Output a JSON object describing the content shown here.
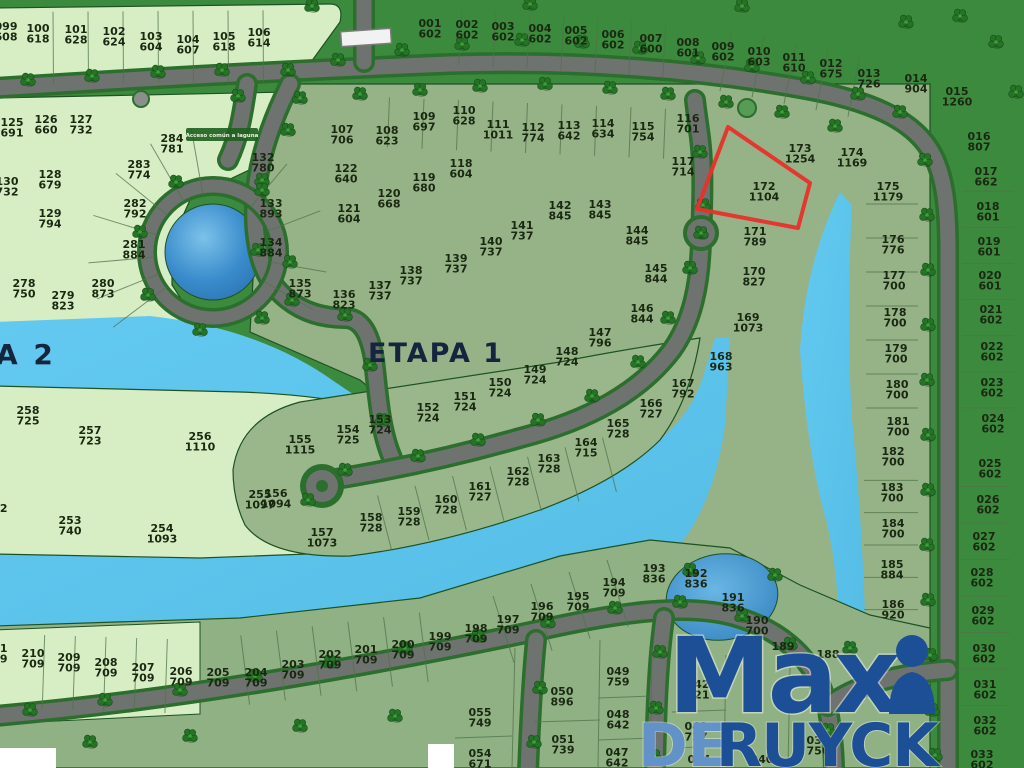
{
  "map": {
    "etapa1_label": "ETAPA 1",
    "etapa2_label": "A 2",
    "acceso_label": "Acceso común a laguna",
    "colors": {
      "water": "#5cc3ea",
      "lagoon": "#3a8ccc",
      "grass": "#3c8a3e",
      "sage_lot": "#96b287",
      "pale_lot": "#d7eec5",
      "road": "#6f736f",
      "hedge": "#2c6e2e",
      "label_text": "#1a2812",
      "etapa_text": "#14253d",
      "highlight_red": "#e8302a",
      "logo_blue": "#1d4f97",
      "logo_light_blue": "#6292c8"
    },
    "highlight": {
      "lot": "172",
      "area": "1104",
      "polygon": [
        [
          728,
          127
        ],
        [
          810,
          183
        ],
        [
          798,
          228
        ],
        [
          697,
          209
        ]
      ]
    },
    "logo": {
      "word1": "Max",
      "word1_suffix_icon": "person-icon",
      "word2a": "DE",
      "word2b": "RUYCK"
    },
    "lots": [
      {
        "n": "099",
        "a": "608",
        "x": 6,
        "y": 30
      },
      {
        "n": "100",
        "a": "618",
        "x": 38,
        "y": 32
      },
      {
        "n": "101",
        "a": "628",
        "x": 76,
        "y": 33
      },
      {
        "n": "102",
        "a": "624",
        "x": 114,
        "y": 35
      },
      {
        "n": "103",
        "a": "604",
        "x": 151,
        "y": 40
      },
      {
        "n": "104",
        "a": "607",
        "x": 188,
        "y": 43
      },
      {
        "n": "105",
        "a": "618",
        "x": 224,
        "y": 40
      },
      {
        "n": "106",
        "a": "614",
        "x": 259,
        "y": 36
      },
      {
        "n": "001",
        "a": "602",
        "x": 430,
        "y": 27
      },
      {
        "n": "002",
        "a": "602",
        "x": 467,
        "y": 28
      },
      {
        "n": "003",
        "a": "602",
        "x": 503,
        "y": 30
      },
      {
        "n": "004",
        "a": "602",
        "x": 540,
        "y": 32
      },
      {
        "n": "005",
        "a": "602",
        "x": 576,
        "y": 34
      },
      {
        "n": "006",
        "a": "602",
        "x": 613,
        "y": 38
      },
      {
        "n": "007",
        "a": "600",
        "x": 651,
        "y": 42
      },
      {
        "n": "008",
        "a": "601",
        "x": 688,
        "y": 46
      },
      {
        "n": "009",
        "a": "602",
        "x": 723,
        "y": 50
      },
      {
        "n": "010",
        "a": "603",
        "x": 759,
        "y": 55
      },
      {
        "n": "011",
        "a": "610",
        "x": 794,
        "y": 61
      },
      {
        "n": "012",
        "a": "675",
        "x": 831,
        "y": 67
      },
      {
        "n": "013",
        "a": "726",
        "x": 869,
        "y": 77
      },
      {
        "n": "014",
        "a": "904",
        "x": 916,
        "y": 82
      },
      {
        "n": "015",
        "a": "1260",
        "x": 957,
        "y": 95
      },
      {
        "n": "016",
        "a": "807",
        "x": 979,
        "y": 140
      },
      {
        "n": "017",
        "a": "662",
        "x": 986,
        "y": 175
      },
      {
        "n": "018",
        "a": "601",
        "x": 988,
        "y": 210
      },
      {
        "n": "019",
        "a": "601",
        "x": 989,
        "y": 245
      },
      {
        "n": "020",
        "a": "601",
        "x": 990,
        "y": 279
      },
      {
        "n": "021",
        "a": "602",
        "x": 991,
        "y": 313
      },
      {
        "n": "022",
        "a": "602",
        "x": 992,
        "y": 350
      },
      {
        "n": "023",
        "a": "602",
        "x": 992,
        "y": 386
      },
      {
        "n": "024",
        "a": "602",
        "x": 993,
        "y": 422
      },
      {
        "n": "025",
        "a": "602",
        "x": 990,
        "y": 467
      },
      {
        "n": "026",
        "a": "602",
        "x": 988,
        "y": 503
      },
      {
        "n": "027",
        "a": "602",
        "x": 984,
        "y": 540
      },
      {
        "n": "028",
        "a": "602",
        "x": 982,
        "y": 576
      },
      {
        "n": "029",
        "a": "602",
        "x": 983,
        "y": 614
      },
      {
        "n": "030",
        "a": "602",
        "x": 984,
        "y": 652
      },
      {
        "n": "031",
        "a": "602",
        "x": 985,
        "y": 688
      },
      {
        "n": "032",
        "a": "602",
        "x": 985,
        "y": 724
      },
      {
        "n": "033",
        "a": "602",
        "x": 982,
        "y": 758
      },
      {
        "n": "173",
        "a": "1254",
        "x": 800,
        "y": 152
      },
      {
        "n": "174",
        "a": "1169",
        "x": 852,
        "y": 156
      },
      {
        "n": "175",
        "a": "1179",
        "x": 888,
        "y": 190
      },
      {
        "n": "176",
        "a": "776",
        "x": 893,
        "y": 243
      },
      {
        "n": "177",
        "a": "700",
        "x": 894,
        "y": 279
      },
      {
        "n": "178",
        "a": "700",
        "x": 895,
        "y": 316
      },
      {
        "n": "179",
        "a": "700",
        "x": 896,
        "y": 352
      },
      {
        "n": "180",
        "a": "700",
        "x": 897,
        "y": 388
      },
      {
        "n": "181",
        "a": "700",
        "x": 898,
        "y": 425
      },
      {
        "n": "182",
        "a": "700",
        "x": 893,
        "y": 455
      },
      {
        "n": "183",
        "a": "700",
        "x": 892,
        "y": 491
      },
      {
        "n": "184",
        "a": "700",
        "x": 893,
        "y": 527
      },
      {
        "n": "185",
        "a": "884",
        "x": 892,
        "y": 568
      },
      {
        "n": "186",
        "a": "920",
        "x": 893,
        "y": 608
      },
      {
        "n": "107",
        "a": "706",
        "x": 342,
        "y": 133
      },
      {
        "n": "108",
        "a": "623",
        "x": 387,
        "y": 134
      },
      {
        "n": "109",
        "a": "697",
        "x": 424,
        "y": 120
      },
      {
        "n": "110",
        "a": "628",
        "x": 464,
        "y": 114
      },
      {
        "n": "111",
        "a": "1011",
        "x": 498,
        "y": 128
      },
      {
        "n": "112",
        "a": "774",
        "x": 533,
        "y": 131
      },
      {
        "n": "113",
        "a": "642",
        "x": 569,
        "y": 129
      },
      {
        "n": "114",
        "a": "634",
        "x": 603,
        "y": 127
      },
      {
        "n": "115",
        "a": "754",
        "x": 643,
        "y": 130
      },
      {
        "n": "116",
        "a": "701",
        "x": 688,
        "y": 122
      },
      {
        "n": "117",
        "a": "714",
        "x": 683,
        "y": 165
      },
      {
        "n": "118",
        "a": "604",
        "x": 461,
        "y": 167
      },
      {
        "n": "119",
        "a": "680",
        "x": 424,
        "y": 181
      },
      {
        "n": "120",
        "a": "668",
        "x": 389,
        "y": 197
      },
      {
        "n": "121",
        "a": "604",
        "x": 349,
        "y": 212
      },
      {
        "n": "122",
        "a": "640",
        "x": 346,
        "y": 172
      },
      {
        "n": "132",
        "a": "780",
        "x": 263,
        "y": 161
      },
      {
        "n": "133",
        "a": "893",
        "x": 271,
        "y": 207
      },
      {
        "n": "134",
        "a": "884",
        "x": 271,
        "y": 246
      },
      {
        "n": "135",
        "a": "873",
        "x": 300,
        "y": 287
      },
      {
        "n": "136",
        "a": "823",
        "x": 344,
        "y": 298
      },
      {
        "n": "125",
        "a": "691",
        "x": 12,
        "y": 126
      },
      {
        "n": "126",
        "a": "660",
        "x": 46,
        "y": 123
      },
      {
        "n": "127",
        "a": "732",
        "x": 81,
        "y": 123
      },
      {
        "n": "128",
        "a": "679",
        "x": 50,
        "y": 178
      },
      {
        "n": "129",
        "a": "794",
        "x": 50,
        "y": 217
      },
      {
        "n": "130",
        "a": "732",
        "x": 7,
        "y": 185
      },
      {
        "n": "284",
        "a": "781",
        "x": 172,
        "y": 142
      },
      {
        "n": "283",
        "a": "774",
        "x": 139,
        "y": 168
      },
      {
        "n": "282",
        "a": "792",
        "x": 135,
        "y": 207
      },
      {
        "n": "281",
        "a": "884",
        "x": 134,
        "y": 248
      },
      {
        "n": "280",
        "a": "873",
        "x": 103,
        "y": 287
      },
      {
        "n": "279",
        "a": "823",
        "x": 63,
        "y": 299
      },
      {
        "n": "278",
        "a": "750",
        "x": 24,
        "y": 287
      },
      {
        "n": "137",
        "a": "737",
        "x": 380,
        "y": 289
      },
      {
        "n": "138",
        "a": "737",
        "x": 411,
        "y": 274
      },
      {
        "n": "139",
        "a": "737",
        "x": 456,
        "y": 262
      },
      {
        "n": "140",
        "a": "737",
        "x": 491,
        "y": 245
      },
      {
        "n": "141",
        "a": "737",
        "x": 522,
        "y": 229
      },
      {
        "n": "142",
        "a": "845",
        "x": 560,
        "y": 209
      },
      {
        "n": "143",
        "a": "845",
        "x": 600,
        "y": 208
      },
      {
        "n": "144",
        "a": "845",
        "x": 637,
        "y": 234
      },
      {
        "n": "145",
        "a": "844",
        "x": 656,
        "y": 272
      },
      {
        "n": "146",
        "a": "844",
        "x": 642,
        "y": 312
      },
      {
        "n": "147",
        "a": "796",
        "x": 600,
        "y": 336
      },
      {
        "n": "148",
        "a": "724",
        "x": 567,
        "y": 355
      },
      {
        "n": "149",
        "a": "724",
        "x": 535,
        "y": 373
      },
      {
        "n": "150",
        "a": "724",
        "x": 500,
        "y": 386
      },
      {
        "n": "151",
        "a": "724",
        "x": 465,
        "y": 400
      },
      {
        "n": "152",
        "a": "724",
        "x": 428,
        "y": 411
      },
      {
        "n": "153",
        "a": "724",
        "x": 380,
        "y": 423
      },
      {
        "n": "154",
        "a": "725",
        "x": 348,
        "y": 433
      },
      {
        "n": "155",
        "a": "1115",
        "x": 300,
        "y": 443
      },
      {
        "n": "156",
        "a": "1094",
        "x": 276,
        "y": 497
      },
      {
        "n": "157",
        "a": "1073",
        "x": 322,
        "y": 536
      },
      {
        "n": "158",
        "a": "728",
        "x": 371,
        "y": 521
      },
      {
        "n": "159",
        "a": "728",
        "x": 409,
        "y": 515
      },
      {
        "n": "160",
        "a": "728",
        "x": 446,
        "y": 503
      },
      {
        "n": "161",
        "a": "727",
        "x": 480,
        "y": 490
      },
      {
        "n": "162",
        "a": "728",
        "x": 518,
        "y": 475
      },
      {
        "n": "163",
        "a": "728",
        "x": 549,
        "y": 462
      },
      {
        "n": "164",
        "a": "715",
        "x": 586,
        "y": 446
      },
      {
        "n": "165",
        "a": "728",
        "x": 618,
        "y": 427
      },
      {
        "n": "166",
        "a": "727",
        "x": 651,
        "y": 407
      },
      {
        "n": "167",
        "a": "792",
        "x": 683,
        "y": 387
      },
      {
        "n": "168",
        "a": "963",
        "x": 721,
        "y": 360
      },
      {
        "n": "169",
        "a": "1073",
        "x": 748,
        "y": 321
      },
      {
        "n": "170",
        "a": "827",
        "x": 754,
        "y": 275
      },
      {
        "n": "171",
        "a": "789",
        "x": 755,
        "y": 235
      },
      {
        "n": "172",
        "a": "1104",
        "x": 764,
        "y": 190
      },
      {
        "n": "258",
        "a": "725",
        "x": 28,
        "y": 414
      },
      {
        "n": "257",
        "a": "723",
        "x": 90,
        "y": 434
      },
      {
        "n": "256",
        "a": "1110",
        "x": 200,
        "y": 440
      },
      {
        "n": "255",
        "a": "1097",
        "x": 260,
        "y": 498
      },
      {
        "n": "254",
        "a": "1093",
        "x": 162,
        "y": 532
      },
      {
        "n": "253",
        "a": "740",
        "x": 70,
        "y": 524
      },
      {
        "n": "252",
        "a": "7",
        "x": -4,
        "y": 512
      },
      {
        "n": "193",
        "a": "836",
        "x": 654,
        "y": 572
      },
      {
        "n": "192",
        "a": "836",
        "x": 696,
        "y": 577
      },
      {
        "n": "191",
        "a": "836",
        "x": 733,
        "y": 601
      },
      {
        "n": "190",
        "a": "700",
        "x": 757,
        "y": 624
      },
      {
        "n": "189",
        "a": "",
        "x": 783,
        "y": 650
      },
      {
        "n": "188",
        "a": "",
        "x": 828,
        "y": 658
      },
      {
        "n": "211",
        "a": "709",
        "x": -4,
        "y": 652
      },
      {
        "n": "210",
        "a": "709",
        "x": 33,
        "y": 657
      },
      {
        "n": "209",
        "a": "709",
        "x": 69,
        "y": 661
      },
      {
        "n": "208",
        "a": "709",
        "x": 106,
        "y": 666
      },
      {
        "n": "207",
        "a": "709",
        "x": 143,
        "y": 671
      },
      {
        "n": "206",
        "a": "709",
        "x": 181,
        "y": 675
      },
      {
        "n": "205",
        "a": "709",
        "x": 218,
        "y": 676
      },
      {
        "n": "204",
        "a": "709",
        "x": 256,
        "y": 676
      },
      {
        "n": "203",
        "a": "709",
        "x": 293,
        "y": 668
      },
      {
        "n": "202",
        "a": "709",
        "x": 330,
        "y": 658
      },
      {
        "n": "201",
        "a": "709",
        "x": 366,
        "y": 653
      },
      {
        "n": "200",
        "a": "709",
        "x": 403,
        "y": 648
      },
      {
        "n": "199",
        "a": "709",
        "x": 440,
        "y": 640
      },
      {
        "n": "198",
        "a": "709",
        "x": 476,
        "y": 632
      },
      {
        "n": "197",
        "a": "709",
        "x": 508,
        "y": 623
      },
      {
        "n": "196",
        "a": "709",
        "x": 542,
        "y": 610
      },
      {
        "n": "195",
        "a": "709",
        "x": 578,
        "y": 600
      },
      {
        "n": "194",
        "a": "709",
        "x": 614,
        "y": 586
      },
      {
        "n": "055",
        "a": "749",
        "x": 480,
        "y": 716
      },
      {
        "n": "054",
        "a": "671",
        "x": 480,
        "y": 757
      },
      {
        "n": "050",
        "a": "896",
        "x": 562,
        "y": 695
      },
      {
        "n": "051",
        "a": "739",
        "x": 563,
        "y": 743
      },
      {
        "n": "049",
        "a": "759",
        "x": 618,
        "y": 675
      },
      {
        "n": "048",
        "a": "642",
        "x": 618,
        "y": 718
      },
      {
        "n": "047",
        "a": "642",
        "x": 617,
        "y": 756
      },
      {
        "n": "042",
        "a": "821",
        "x": 698,
        "y": 688
      },
      {
        "n": "043",
        "a": "727",
        "x": 696,
        "y": 730
      },
      {
        "n": "044",
        "a": "",
        "x": 699,
        "y": 763
      },
      {
        "n": "040",
        "a": "",
        "x": 762,
        "y": 763
      },
      {
        "n": "037",
        "a": "756",
        "x": 818,
        "y": 744
      }
    ]
  }
}
